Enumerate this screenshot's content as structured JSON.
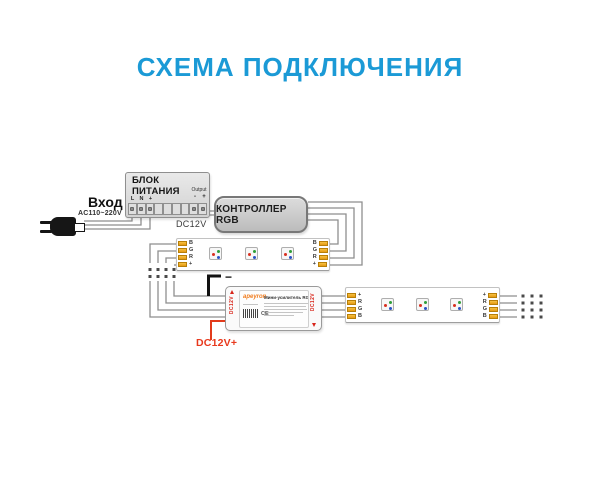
{
  "title": "СХЕМА ПОДКЛЮЧЕНИЯ",
  "colors": {
    "title_blue": "#1b9ad6",
    "wire_gray": "#8e8e8e",
    "wire_red": "#e23b1c",
    "wire_black": "#111111",
    "terminal_gold": "#f0ae1c",
    "brand_orange": "#f07c1e"
  },
  "ac_input": {
    "label": "Вход",
    "voltage": "AC110~220V"
  },
  "power_supply": {
    "name_lines": [
      "БЛОК",
      "ПИТАНИЯ"
    ],
    "input_terminals": [
      "L",
      "N",
      "+"
    ],
    "output_label": "Output",
    "output_polarity": [
      "-",
      "+"
    ],
    "output_voltage": "DC12V"
  },
  "controller": {
    "label": "КОНТРОЛЛЕР RGB"
  },
  "strip_upper": {
    "pins": [
      "B",
      "G",
      "R",
      "+"
    ],
    "led_count": 3
  },
  "amplifier": {
    "brand": "apeyron",
    "product_title": "Мини-усилитель RGB",
    "port_left_label": "DC12V",
    "port_right_label": "DC12V",
    "ce_mark": "CE"
  },
  "strip_lower": {
    "pins": [
      "+",
      "R",
      "G",
      "B"
    ],
    "led_count": 3
  },
  "amp_power": {
    "minus_label": "−",
    "plus_label": "DC12V+"
  }
}
